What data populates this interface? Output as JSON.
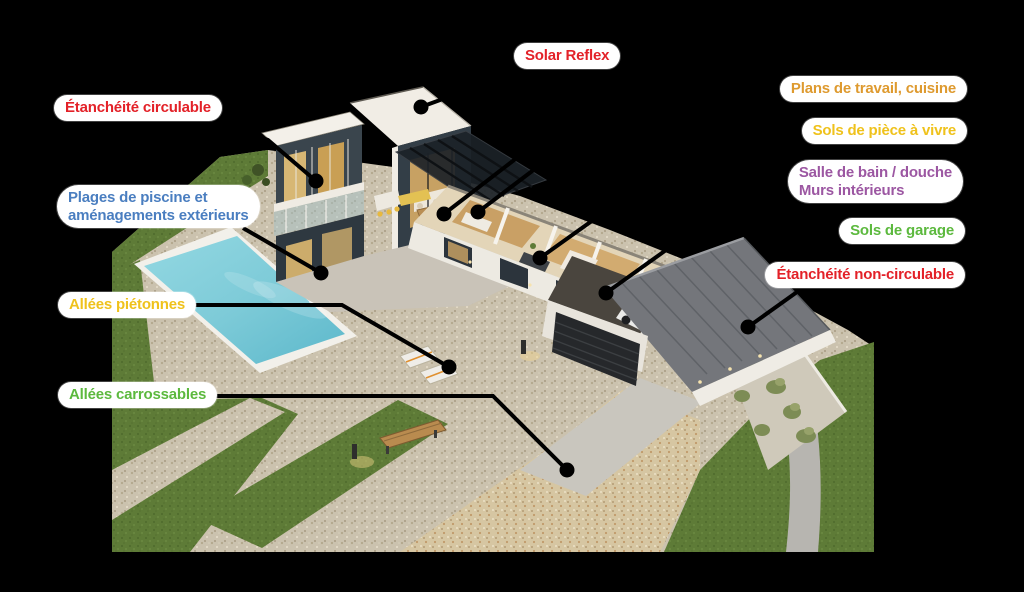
{
  "colors": {
    "red": "#E32128",
    "orange": "#DE9A2F",
    "gold": "#EFC21C",
    "purple": "#9C57A2",
    "green": "#5CB93E",
    "blue": "#4A7EC0"
  },
  "pill": {
    "bg": "#FFFFFF"
  },
  "line_style": {
    "color": "#000000",
    "width": 4,
    "dot_radius": 7.5
  },
  "annotations": [
    {
      "id": "solar-reflex",
      "text": [
        "Solar Reflex"
      ],
      "color": "red",
      "anchor": {
        "left": 514,
        "top": 43
      },
      "align": "center",
      "leader": [
        [
          530,
          67
        ],
        [
          421,
          107
        ]
      ],
      "dot": [
        421,
        107
      ]
    },
    {
      "id": "etancheite-circulable",
      "text": [
        "Étanchéité circulable"
      ],
      "color": "red",
      "anchor": {
        "left": 54,
        "top": 95
      },
      "align": "center",
      "leader": [
        [
          205,
          118
        ],
        [
          268,
          140
        ],
        [
          316,
          181
        ]
      ],
      "dot": [
        316,
        181
      ]
    },
    {
      "id": "plages-piscine-amenagements",
      "text": [
        "Plages de piscine et",
        "aménagements extérieurs"
      ],
      "color": "blue",
      "anchor": {
        "left": 57,
        "top": 185
      },
      "align": "left",
      "leader": [
        [
          243,
          228
        ],
        [
          321,
          273
        ]
      ],
      "dot": [
        321,
        273
      ]
    },
    {
      "id": "allees-pietonnes",
      "text": [
        "Allées piétonnes"
      ],
      "color": "gold",
      "anchor": {
        "left": 58,
        "top": 292
      },
      "align": "center",
      "leader": [
        [
          187,
          305
        ],
        [
          342,
          305
        ],
        [
          449,
          367
        ]
      ],
      "dot": [
        449,
        367
      ]
    },
    {
      "id": "allees-carrossables",
      "text": [
        "Allées carrossables"
      ],
      "color": "green",
      "anchor": {
        "left": 58,
        "top": 382
      },
      "align": "center",
      "leader": [
        [
          206,
          396
        ],
        [
          493,
          396
        ],
        [
          567,
          470
        ]
      ],
      "dot": [
        567,
        470
      ]
    },
    {
      "id": "plans-de-travail-cuisine",
      "text": [
        "Plans de travail, cuisine"
      ],
      "color": "orange",
      "anchor": {
        "right": 57,
        "top": 76
      },
      "align": "center",
      "leader": [
        [
          789,
          99
        ],
        [
          540,
          140
        ],
        [
          444,
          214
        ]
      ],
      "dot": [
        444,
        214
      ]
    },
    {
      "id": "sols-de-piece-a-vivre",
      "text": [
        "Sols de pièce à vivre"
      ],
      "color": "gold",
      "anchor": {
        "right": 57,
        "top": 118
      },
      "align": "center",
      "leader": [
        [
          810,
          144
        ],
        [
          560,
          150
        ],
        [
          478,
          212
        ]
      ],
      "dot": [
        478,
        212
      ]
    },
    {
      "id": "salle-de-bain-murs-interieurs",
      "text": [
        "Salle de bain / douche",
        "Murs intérieurs"
      ],
      "color": "purple",
      "anchor": {
        "right": 61,
        "top": 160
      },
      "align": "left",
      "leader": [
        [
          801,
          198
        ],
        [
          610,
          208
        ],
        [
          540,
          258
        ]
      ],
      "dot": [
        540,
        258
      ]
    },
    {
      "id": "sols-de-garage",
      "text": [
        "Sols de garage"
      ],
      "color": "green",
      "anchor": {
        "right": 59,
        "top": 218
      },
      "align": "center",
      "leader": [
        [
          850,
          244
        ],
        [
          743,
          195
        ],
        [
          606,
          293
        ]
      ],
      "dot": [
        606,
        293
      ]
    },
    {
      "id": "etancheite-non-circulable",
      "text": [
        "Étanchéité non-circulable"
      ],
      "color": "red",
      "anchor": {
        "right": 59,
        "top": 262
      },
      "align": "center",
      "leader": [
        [
          797,
          292
        ],
        [
          748,
          327
        ]
      ],
      "dot": [
        748,
        327
      ]
    }
  ]
}
